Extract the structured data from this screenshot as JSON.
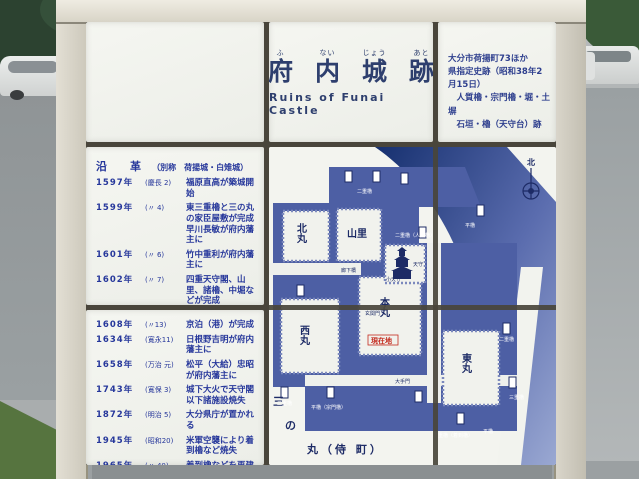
{
  "colors": {
    "sign_text_blue": "#2e3f8e",
    "map_blue": "#4d5fa4",
    "map_dark_water": "#16306f",
    "current_location_red": "#c42a1e"
  },
  "sign": {
    "title": {
      "furigana": [
        "ふ",
        "ない",
        "じょう",
        "あと"
      ],
      "kanji": [
        "府",
        "内",
        "城",
        "跡"
      ],
      "english": "Ruins of Funai Castle"
    },
    "designation": "大分市荷揚町73ほか\n県指定史跡（昭和38年2月15日）\n　人質櫓・宗門櫓・堀・土塀\n　石垣・櫓（天守台）跡",
    "history": {
      "heading": "沿　革",
      "note": "（別称　荷揚城・白雉城）",
      "entries": [
        {
          "year": "1597年",
          "era": "(慶長 2)",
          "text": "福原直高が築城開始"
        },
        {
          "year": "1599年",
          "era": "(〃 4)",
          "text": "東三重櫓と三の丸の家臣屋敷が完成\n早川長敏が府内藩主に"
        },
        {
          "year": "1601年",
          "era": "(〃 6)",
          "text": "竹中重利が府内藩主に"
        },
        {
          "year": "1602年",
          "era": "(〃 7)",
          "text": "四重天守閣、山里、諸櫓、中堀などが完成"
        },
        {
          "year": "1605年",
          "era": "(〃10)",
          "text": "外堀が完成"
        },
        {
          "year": "1607年",
          "era": "(〃12)",
          "text": "笠和口、堀川口、塩九升口の門が完成"
        },
        {
          "year": "1608年",
          "era": "(〃13)",
          "text": "京泊（港）が完成"
        },
        {
          "year": "1634年",
          "era": "(寛永11)",
          "text": "日根野吉明が府内藩主に"
        },
        {
          "year": "1658年",
          "era": "(万治 元)",
          "text": "松平（大給）忠昭が府内藩主に"
        },
        {
          "year": "1743年",
          "era": "(寛保 3)",
          "text": "城下大火で天守閣以下諸施設焼失"
        },
        {
          "year": "1872年",
          "era": "(明治 5)",
          "text": "大分県庁が置かれる"
        },
        {
          "year": "1945年",
          "era": "(昭和20)",
          "text": "米軍空襲により着到櫓など焼失"
        },
        {
          "year": "1965年",
          "era": "(〃 40)",
          "text": "着到櫓などを再建"
        }
      ],
      "credit": "大分市教育委員会"
    },
    "map": {
      "compass_north": "北",
      "areas": {
        "kitamaru": "北丸",
        "yamazato": "山里",
        "honmaru": "本丸",
        "nishimaru": "西丸",
        "higashimaru": "東丸"
      },
      "sannomaru": {
        "char1": "三",
        "char2": "の",
        "rest": "丸（侍 町）"
      },
      "current_location": "現在地",
      "small_labels": [
        "二重櫓",
        "二重櫓（人質櫓）",
        "平櫓",
        "天守",
        "小天守",
        "廊下橋",
        "玄関門",
        "大手門",
        "平櫓（宗門櫓）",
        "二重櫓",
        "二重櫓（着到櫓）",
        "平櫓",
        "三重櫓",
        "二重櫓"
      ]
    }
  }
}
